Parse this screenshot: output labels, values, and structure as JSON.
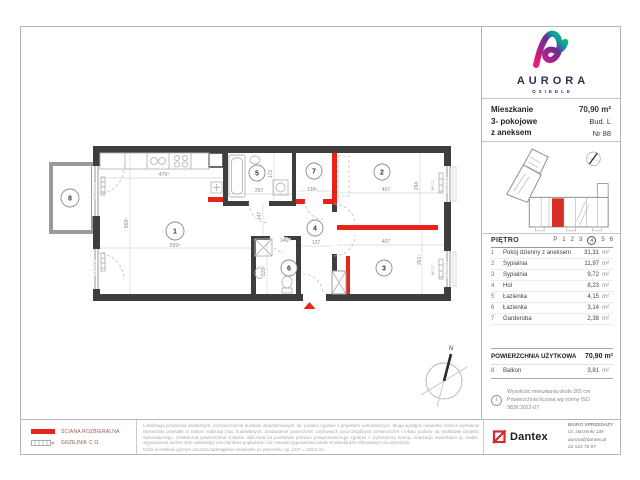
{
  "brand": {
    "name": "AURORA",
    "subtitle": "OSIEDLE"
  },
  "unit_header": {
    "line1": "Mieszkanie",
    "line2": "3- pokojowe",
    "line3": "z aneksem",
    "area": "70,90 m²",
    "building": "Bud. L",
    "number": "Nr 88"
  },
  "floor_selector": {
    "label": "PIĘTRO",
    "options": [
      "P",
      "1",
      "2",
      "3",
      "4",
      "5",
      "6"
    ],
    "selected": "4"
  },
  "rooms": [
    {
      "no": "1",
      "name": "Pokój dzienny z aneksem",
      "area": "31,31",
      "unit": "m²"
    },
    {
      "no": "2",
      "name": "Sypialnia",
      "area": "11,97",
      "unit": "m²"
    },
    {
      "no": "3",
      "name": "Sypialnia",
      "area": "9,72",
      "unit": "m²"
    },
    {
      "no": "4",
      "name": "Hol",
      "area": "8,23",
      "unit": "m²"
    },
    {
      "no": "5",
      "name": "Łazienka",
      "area": "4,15",
      "unit": "m²"
    },
    {
      "no": "6",
      "name": "Łazienka",
      "area": "3,14",
      "unit": "m²"
    },
    {
      "no": "7",
      "name": "Garderoba",
      "area": "2,38",
      "unit": "m²"
    }
  ],
  "summary": {
    "label": "POWIERZCHNIA UŻYTKOWA",
    "area": "70,90",
    "unit": "m²"
  },
  "balcony_row": {
    "no": "8",
    "name": "Balkon",
    "area": "3,81",
    "unit": "m²"
  },
  "notes": {
    "icon": "i",
    "line1": "Wysokość mieszkania około 265 cm",
    "line2": "Powierzchnia liczona wg normy ISO 9836:2022-07"
  },
  "legend": {
    "wall": "ŚCIANA ROZBIERALNA",
    "radiator": "GRZEJNIK C.O."
  },
  "disclaimer": {
    "p1": "Lokalizacja przyborów sanitarnych, rozmieszczenie punktów oświetleniowych, itp. podano zgodnie z projektem wykonawczym. Mogą wystąpić niewielkie różnice wymiarów elementów powstałe w trakcie realizacji prac budowlanych. Zestawienie powierzchni użytkowych poszczególnych pomieszczeń i lokalu podano na podstawie projektu wykonawczego.",
    "p2": "Ostateczna powierzchnia zostanie obliczona na podstawie pomiaru powykonawczego zgodnie z wymienioną normą. Aranżacja mieszkania (tj. meble, wyposażenie kuchni oraz sanitariaty) ma charakter poglądowy i nie stanowi wyposażenia lokalu w standardzie oferowanym do sprzedaży.",
    "p3": "Cyfra w indeksie górnym oznacza zaokrąglenie dziesiętne po przecinku, np. 123⁵ = 123,5 cm."
  },
  "sales_office": {
    "title": "BIURO SPRZEDAŻY",
    "address": "Ul. Jutrzenki 139",
    "email": "aurora@dantex.pl",
    "phone": "22 123 75 97"
  },
  "developer": {
    "name": "Dantex"
  },
  "plan": {
    "compass": "N",
    "rooms": {
      "r1": "1",
      "r2": "2",
      "r3": "3",
      "r4": "4",
      "r5": "5",
      "r6": "6",
      "r7": "7",
      "r8": "8"
    },
    "dims": {
      "living_w": "479⁵",
      "living_h": "568⁵",
      "living_l": "599⁵",
      "bath5_w": "257",
      "bath5_h": "172",
      "ward_w": "138⁵",
      "hol_w": "127",
      "hol_h": "147",
      "hol_w2": "146⁵",
      "bath6_h": "228⁵",
      "bed2_w": "407",
      "bed2_h": "294",
      "bed3_w": "407",
      "bed3_h": "261¹",
      "win_l1": "200x234",
      "win_l2": "110x234",
      "win_r1": "100x215",
      "win_r2": "100x215",
      "np_r1": "NP-17",
      "np_r2": "NP-17"
    },
    "colors": {
      "wall": "#3e3e3e",
      "removable_wall": "#e8231a",
      "highlight_unit": "#d93025"
    }
  }
}
